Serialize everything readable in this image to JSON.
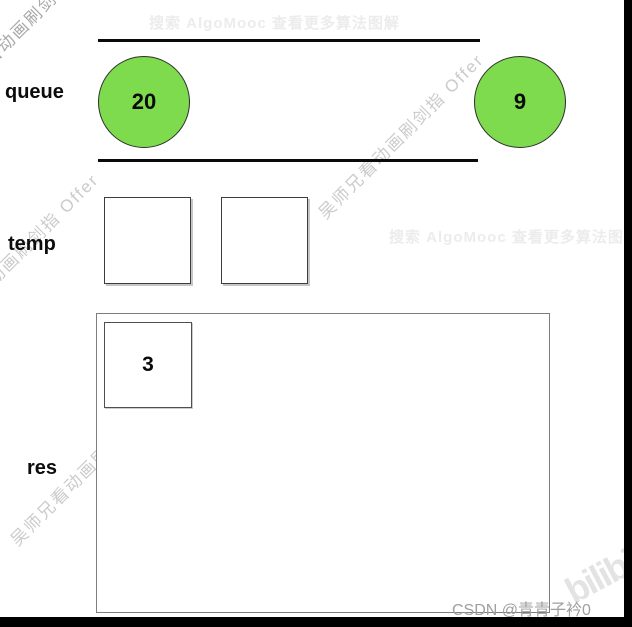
{
  "watermarks": {
    "algomooc_banner": "搜索 AlgoMooc 查看更多算法图解",
    "diagonal_text": "吴师兄看动画刷剑指 Offer",
    "bilibili_logo_text": "bilibili",
    "csdn_credit": "CSDN @青青子衿0"
  },
  "labels": {
    "queue": "queue",
    "temp": "temp",
    "res": "res"
  },
  "queue": {
    "items": [
      {
        "value": "20"
      },
      {
        "value": "9"
      }
    ]
  },
  "temp": {
    "slots": [
      {
        "value": ""
      },
      {
        "value": ""
      }
    ]
  },
  "res": {
    "items": [
      {
        "value": "3"
      }
    ]
  },
  "colors": {
    "node_fill_green": "#7edb4e",
    "node_border": "#2d2d2d",
    "lane_line": "#0a0a0a",
    "watermark_gray": "#cbcbcb",
    "credit_gray": "#9f9f9f",
    "letterbox_black": "#000000"
  }
}
